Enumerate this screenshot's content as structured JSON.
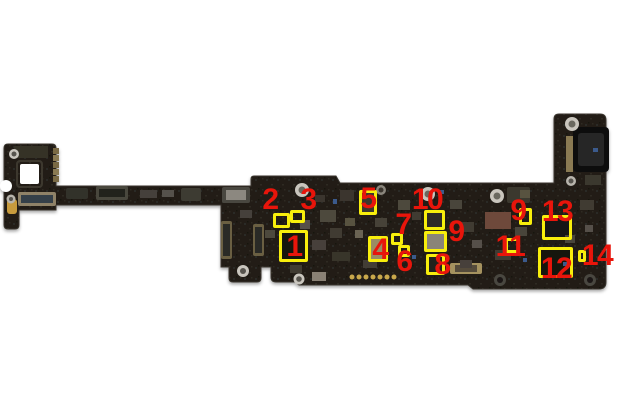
{
  "image": {
    "background": "#ffffff",
    "board_color": "#211e19",
    "highlight_color": "#f8ee0c",
    "label_color": "#e8150b"
  },
  "callouts": [
    {
      "label": "1",
      "num_x": 294,
      "num_y": 247,
      "box_x": 279,
      "box_y": 230,
      "box_w": 29,
      "box_h": 32
    },
    {
      "label": "2",
      "num_x": 270,
      "num_y": 200,
      "box_x": 273,
      "box_y": 213,
      "box_w": 17,
      "box_h": 15
    },
    {
      "label": "3",
      "num_x": 308,
      "num_y": 200,
      "box_x": 290,
      "box_y": 210,
      "box_w": 15,
      "box_h": 13
    },
    {
      "label": "4",
      "num_x": 380,
      "num_y": 250,
      "box_x": 368,
      "box_y": 236,
      "box_w": 20,
      "box_h": 26
    },
    {
      "label": "5",
      "num_x": 368,
      "num_y": 199,
      "box_x": 359,
      "box_y": 190,
      "box_w": 18,
      "box_h": 25
    },
    {
      "label": "6",
      "num_x": 404,
      "num_y": 262,
      "box_x": 398,
      "box_y": 245,
      "box_w": 12,
      "box_h": 12
    },
    {
      "label": "7",
      "num_x": 403,
      "num_y": 225,
      "box_x": 391,
      "box_y": 233,
      "box_w": 12,
      "box_h": 12
    },
    {
      "label": "8",
      "num_x": 442,
      "num_y": 265,
      "box_x": 426,
      "box_y": 254,
      "box_w": 19,
      "box_h": 21
    },
    {
      "label": "9",
      "num_x": 456,
      "num_y": 232,
      "box_x": 424,
      "box_y": 231,
      "box_w": 23,
      "box_h": 21
    },
    {
      "label": "10",
      "num_x": 427,
      "num_y": 200,
      "box_x": 424,
      "box_y": 210,
      "box_w": 21,
      "box_h": 20
    },
    {
      "label": "9",
      "num_x": 518,
      "num_y": 211,
      "box_x": 519,
      "box_y": 208,
      "box_w": 13,
      "box_h": 17
    },
    {
      "label": "11",
      "num_x": 510,
      "num_y": 247,
      "box_x": 505,
      "box_y": 238,
      "box_w": 15,
      "box_h": 15
    },
    {
      "label": "12",
      "num_x": 556,
      "num_y": 269,
      "box_x": 538,
      "box_y": 247,
      "box_w": 35,
      "box_h": 31
    },
    {
      "label": "13",
      "num_x": 557,
      "num_y": 212,
      "box_x": 542,
      "box_y": 215,
      "box_w": 30,
      "box_h": 25
    },
    {
      "label": "14",
      "num_x": 597,
      "num_y": 256,
      "box_x": 578,
      "box_y": 250,
      "box_w": 8,
      "box_h": 12
    }
  ]
}
